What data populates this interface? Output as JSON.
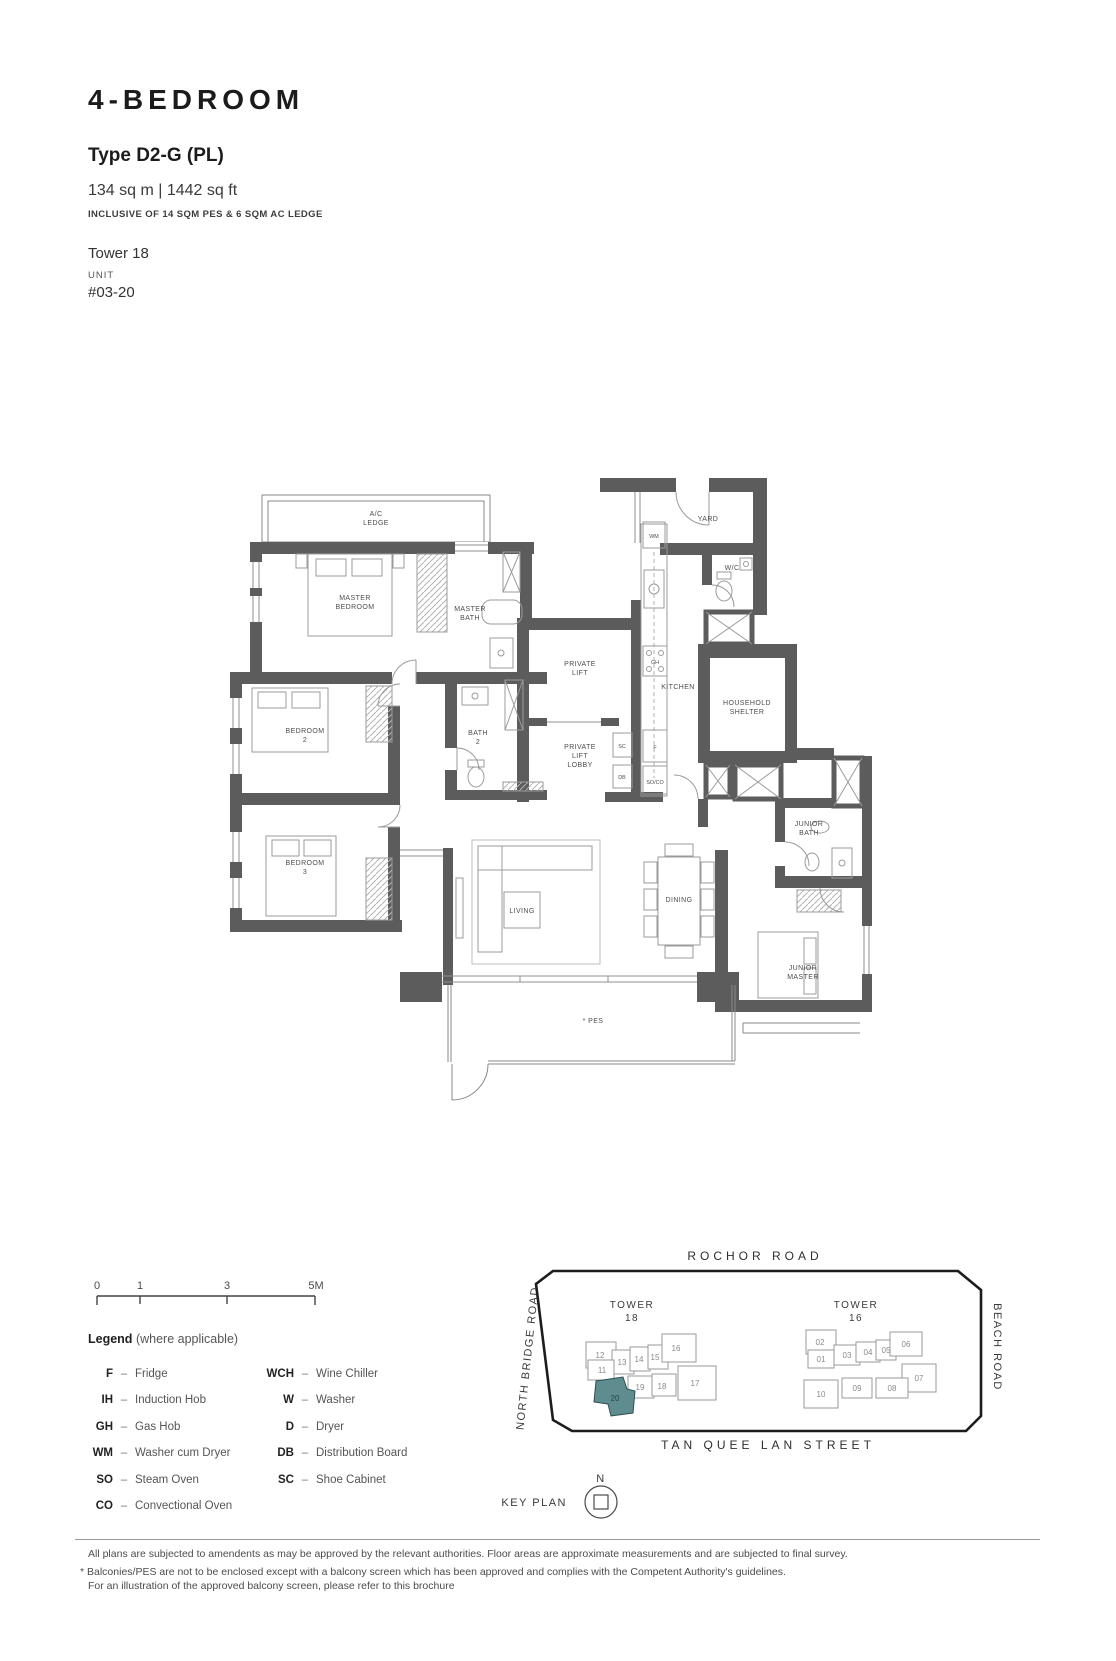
{
  "header": {
    "title": "4-BEDROOM",
    "type": "Type D2-G (PL)",
    "area": "134 sq m | 1442 sq ft",
    "inclusive": "INCLUSIVE OF 14 SQM PES & 6 SQM AC LEDGE",
    "tower_label": "Tower 18",
    "unit_label": "UNIT",
    "unit_number": "#03-20"
  },
  "plan": {
    "rooms": {
      "ac_ledge": [
        "A/C",
        "LEDGE"
      ],
      "master_bedroom": [
        "MASTER",
        "BEDROOM"
      ],
      "master_bath": [
        "MASTER",
        "BATH"
      ],
      "bedroom2": [
        "BEDROOM",
        "2"
      ],
      "bath2": [
        "BATH",
        "2"
      ],
      "private_lift": [
        "PRIVATE",
        "LIFT"
      ],
      "private_lift_lobby": [
        "PRIVATE",
        "LIFT",
        "LOBBY"
      ],
      "kitchen": "KITCHEN",
      "yard": "YARD",
      "wc": "W/C",
      "household_shelter": [
        "HOUSEHOLD",
        "SHELTER"
      ],
      "junior_bath": [
        "JUNIOR",
        "BATH"
      ],
      "bedroom3": [
        "BEDROOM",
        "3"
      ],
      "living": "LIVING",
      "dining": "DINING",
      "junior_master": [
        "JUNIOR",
        "MASTER"
      ],
      "pes": "* PES"
    },
    "appliances": {
      "wm": "WM",
      "gh": "GH",
      "f": "F",
      "so_co": "SO/CO",
      "sc": "SC",
      "db": "DB"
    }
  },
  "scalebar": {
    "ticks": [
      "0",
      "1",
      "3",
      "5M"
    ]
  },
  "legend": {
    "title": "Legend",
    "subtitle": "(where applicable)",
    "dash": "–",
    "col1": [
      {
        "abbr": "F",
        "desc": "Fridge"
      },
      {
        "abbr": "IH",
        "desc": "Induction Hob"
      },
      {
        "abbr": "GH",
        "desc": "Gas Hob"
      },
      {
        "abbr": "WM",
        "desc": "Washer cum Dryer"
      },
      {
        "abbr": "SO",
        "desc": "Steam Oven"
      },
      {
        "abbr": "CO",
        "desc": "Convectional Oven"
      }
    ],
    "col2": [
      {
        "abbr": "WCH",
        "desc": "Wine Chiller"
      },
      {
        "abbr": "W",
        "desc": "Washer"
      },
      {
        "abbr": "D",
        "desc": "Dryer"
      },
      {
        "abbr": "DB",
        "desc": "Distribution Board"
      },
      {
        "abbr": "SC",
        "desc": "Shoe Cabinet"
      }
    ]
  },
  "keyplan": {
    "label": "KEY PLAN",
    "north": "N",
    "highlight_color": "#5E8C8F",
    "roads": {
      "top": "ROCHOR ROAD",
      "left": "NORTH BRIDGE ROAD",
      "right": "BEACH ROAD",
      "bottom": "TAN QUEE LAN STREET"
    },
    "towers": [
      {
        "name": "TOWER",
        "number": "18"
      },
      {
        "name": "TOWER",
        "number": "16"
      }
    ],
    "tower18_units": [
      "12",
      "13",
      "14",
      "15",
      "16",
      "11",
      "19",
      "18",
      "17"
    ],
    "highlighted_unit": "20",
    "tower16_units": [
      "02",
      "01",
      "03",
      "04",
      "05",
      "06",
      "07",
      "08",
      "09",
      "10"
    ]
  },
  "footer": {
    "line1": "All plans are subjected to amendents as may be approved by the relevant authorities. Floor areas are approximate measurements and are subjected to final survey.",
    "line2": "* Balconies/PES are not to be enclosed except with a balcony screen which has been approved and complies with the Competent Authority's guidelines.",
    "line3": "For an illustration of the approved balcony screen, please refer to this brochure"
  }
}
